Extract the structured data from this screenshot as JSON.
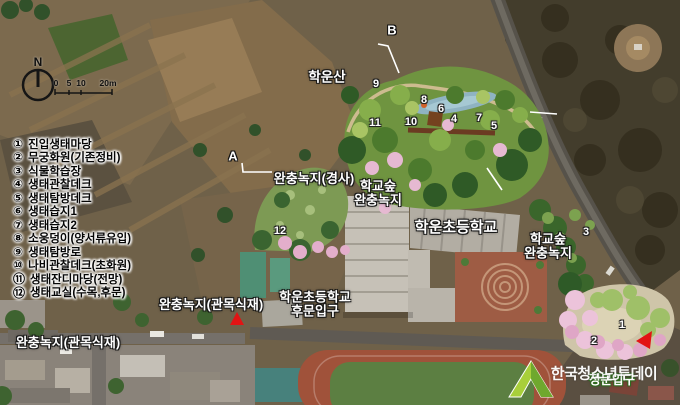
{
  "compass": {
    "label": "N"
  },
  "scale_bar": {
    "ticks": [
      {
        "label": "0",
        "x": 56
      },
      {
        "label": "5",
        "x": 69
      },
      {
        "label": "10",
        "x": 81
      },
      {
        "label": "20m",
        "x": 108
      }
    ]
  },
  "legend": {
    "items": [
      {
        "num": "①",
        "label": "진입생태마당"
      },
      {
        "num": "②",
        "label": "무궁화원(기존정비)"
      },
      {
        "num": "③",
        "label": "식물학습장"
      },
      {
        "num": "④",
        "label": "생태관찰데크"
      },
      {
        "num": "⑤",
        "label": "생태탐방데크"
      },
      {
        "num": "⑥",
        "label": "생태습지1"
      },
      {
        "num": "⑦",
        "label": "생태습지2"
      },
      {
        "num": "⑧",
        "label": "소웅덩이(양서류유입)"
      },
      {
        "num": "⑨",
        "label": "생태탐방로"
      },
      {
        "num": "⑩",
        "label": "나비관찰데크(초화원)"
      },
      {
        "num": "⑪",
        "label": "생태잔디마당(전망)"
      },
      {
        "num": "⑫",
        "label": "생태교실(수목,후문)"
      }
    ]
  },
  "map_labels": [
    {
      "text": "학운산",
      "x": 327,
      "y": 78,
      "size": 13.5
    },
    {
      "text": "완충녹지(경사)",
      "x": 314,
      "y": 179,
      "size": 13
    },
    {
      "lines": [
        "학교숲",
        "완충녹지"
      ],
      "x": 378,
      "y": 194,
      "size": 13
    },
    {
      "text": "학운초등학교",
      "x": 456,
      "y": 228,
      "size": 15
    },
    {
      "lines": [
        "학교숲",
        "완충녹지"
      ],
      "x": 548,
      "y": 247,
      "size": 13
    },
    {
      "text": "완충녹지(관목식재)",
      "x": 211,
      "y": 305,
      "size": 13
    },
    {
      "lines": [
        "학운초등학교",
        "후문입구"
      ],
      "x": 315,
      "y": 305,
      "size": 13
    },
    {
      "text": "완충녹지(관목식재)",
      "x": 68,
      "y": 343,
      "size": 13
    },
    {
      "text": "정문입구",
      "x": 612,
      "y": 381,
      "size": 12.5,
      "cls": "gate"
    }
  ],
  "site_numbers": [
    {
      "n": "1",
      "x": 622,
      "y": 325
    },
    {
      "n": "2",
      "x": 594,
      "y": 341
    },
    {
      "n": "3",
      "x": 586,
      "y": 232
    },
    {
      "n": "4",
      "x": 454,
      "y": 119
    },
    {
      "n": "5",
      "x": 494,
      "y": 126
    },
    {
      "n": "6",
      "x": 441,
      "y": 109
    },
    {
      "n": "7",
      "x": 479,
      "y": 118
    },
    {
      "n": "8",
      "x": 424,
      "y": 100
    },
    {
      "n": "9",
      "x": 376,
      "y": 84
    },
    {
      "n": "10",
      "x": 411,
      "y": 122
    },
    {
      "n": "11",
      "x": 375,
      "y": 123
    },
    {
      "n": "12",
      "x": 280,
      "y": 231
    }
  ],
  "section_markers": [
    {
      "label": "A",
      "x": 233,
      "y": 156
    },
    {
      "label": "B",
      "x": 392,
      "y": 30
    }
  ],
  "watermark": {
    "text": "한국청소년투데이"
  },
  "colors": {
    "marker_red": "#e21414",
    "label_white": "#ffffff",
    "watermark_lime": "#a8cf3a"
  }
}
